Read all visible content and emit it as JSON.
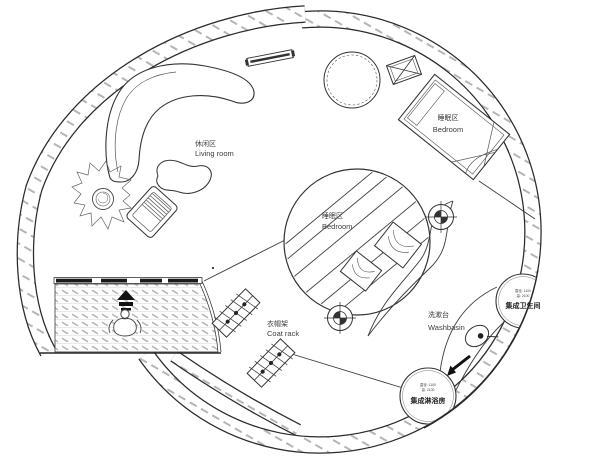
{
  "drawing": {
    "title": "circular tiny-home floor plan",
    "labels": {
      "living_room": {
        "zh": "休闲区",
        "en": "Living room"
      },
      "bedroom_loft": {
        "zh": "睡眠区",
        "en": "Bedroom"
      },
      "bedroom_center": {
        "zh": "睡眠区",
        "en": "Bedroom"
      },
      "coat_rack": {
        "zh": "衣帽架",
        "en": "Coat rack"
      },
      "washbasin": {
        "zh": "洗漱台",
        "en": "Washbasin"
      },
      "bathroom_pod": {
        "zh": "集成卫生间",
        "dim1": "直径: 1100",
        "dim2": "高: 2100"
      },
      "shower_pod": {
        "zh": "集成淋浴房",
        "dim1": "直径: 1100",
        "dim2": "高: 2100"
      }
    },
    "colors": {
      "line": "#2a2a2a",
      "thin_line": "#3a3a3a",
      "wall_hatch": "#b5b5b5",
      "floor_hatch": "#c0c0c0",
      "label": "#3d3d3d",
      "background": "#ffffff"
    }
  }
}
